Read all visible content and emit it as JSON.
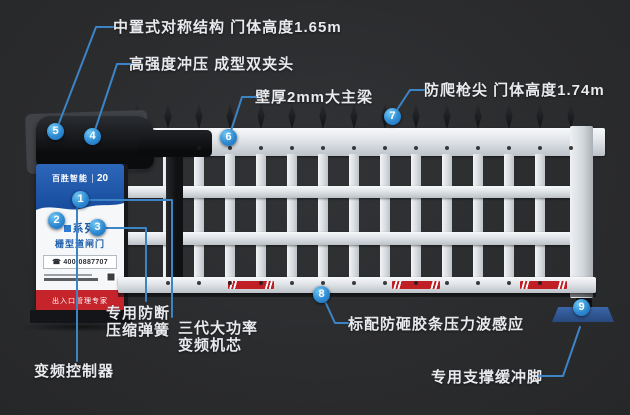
{
  "colors": {
    "background": "#2b2c2e",
    "leader_line_blue": "#3d84c6",
    "callout_blue": "#2e8ad2",
    "fence_white": "#e9ecef",
    "reflective_red": "#c01f26",
    "cabinet_blue": "#1d5cab",
    "banner_red": "#c5242b"
  },
  "callouts": [
    "1",
    "2",
    "3",
    "4",
    "5",
    "6",
    "7",
    "8",
    "9"
  ],
  "labels": {
    "center_structure": "中置式对称结构  门体高度1.65m",
    "clamp_head": "高强度冲压  成型双夹头",
    "main_beam": "壁厚2mm大主梁",
    "anti_climb": "防爬枪尖  门体高度1.74m",
    "spring_line1": "专用防断",
    "spring_line2": "压缩弹簧",
    "motor_line1": "三代大功率",
    "motor_line2": "变频机芯",
    "controller": "变频控制器",
    "pressure_sensor": "标配防砸胶条压力波感应",
    "support_foot": "专用支撑缓冲脚"
  },
  "cabinet": {
    "brand": "百胜智能",
    "brand_year": "20",
    "series_line1": "系列",
    "series_line2": "栅型道闸门",
    "hotline": "☎ 400-0887707",
    "banner": "出入口管理专家"
  }
}
